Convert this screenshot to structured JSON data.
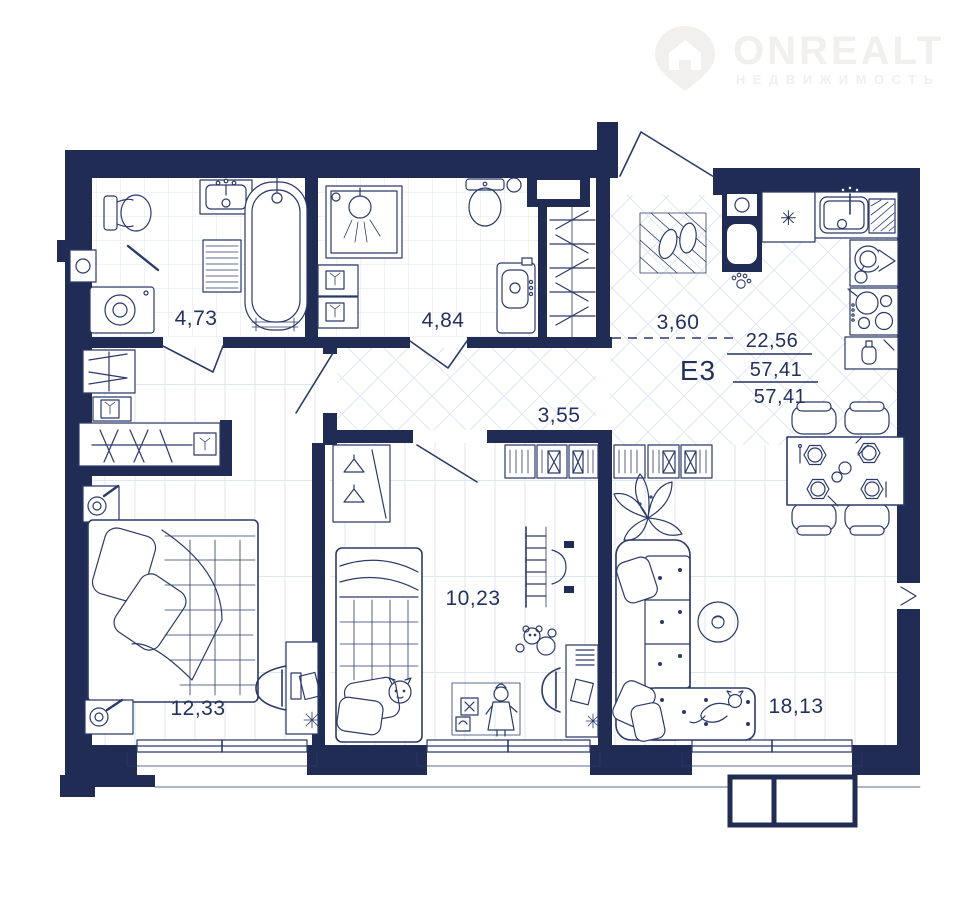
{
  "logo": {
    "brand": "ONREALT",
    "tagline": "НЕДВИЖИМОСТЬ",
    "icon": "house-pin"
  },
  "unit": {
    "label": "Е3",
    "living_area": "22,56",
    "total_area": "57,41",
    "total_area_reduced": "57,41"
  },
  "rooms": {
    "bathroom_main": {
      "area": "4,73"
    },
    "bathroom_second": {
      "area": "4,84"
    },
    "hallway": {
      "area": "3,60"
    },
    "corridor": {
      "area": "3,55"
    },
    "kids_room": {
      "area": "10,23"
    },
    "bedroom": {
      "area": "12,33"
    },
    "living_room": {
      "area": "18,13"
    }
  },
  "icons": {
    "fridge_snowflake": "✳"
  },
  "colors": {
    "wall": "#202c54",
    "line": "#2b3a68",
    "text": "#24315c",
    "floor-line": "#dfe7f2",
    "logo": "#f1f0ee",
    "bg": "#ffffff"
  }
}
